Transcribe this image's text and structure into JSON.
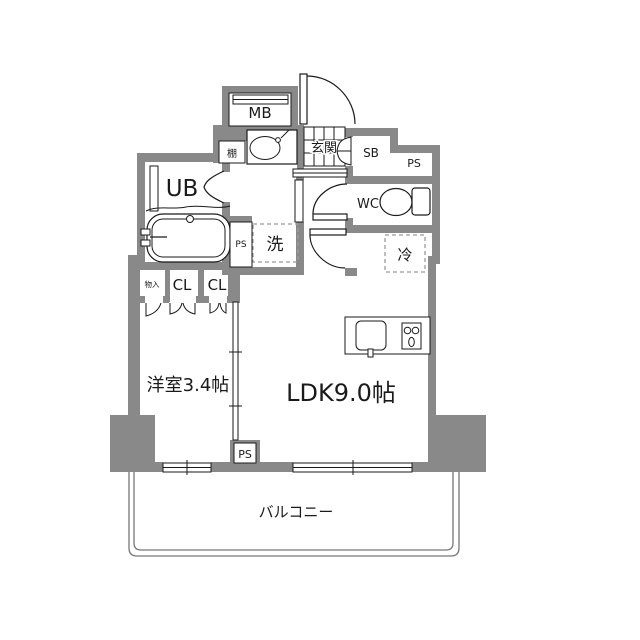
{
  "colors": {
    "wall": "#898989",
    "line": "#1a1a1a",
    "dash": "#9a9a9a",
    "thin": "#777777"
  },
  "labels": {
    "mb": "MB",
    "shelf": "棚",
    "entrance": "玄関",
    "shoe_box": "SB",
    "ps_upper": "PS",
    "unit_bath": "UB",
    "toilet": "WC",
    "washer": "洗",
    "fridge": "冷",
    "ps_bath": "PS",
    "storage": "物入",
    "closet_left": "CL",
    "closet_right": "CL",
    "western_room": "洋室3.4帖",
    "ldk": "LDK9.0帖",
    "ps_lower": "PS",
    "balcony": "バルコニー"
  }
}
